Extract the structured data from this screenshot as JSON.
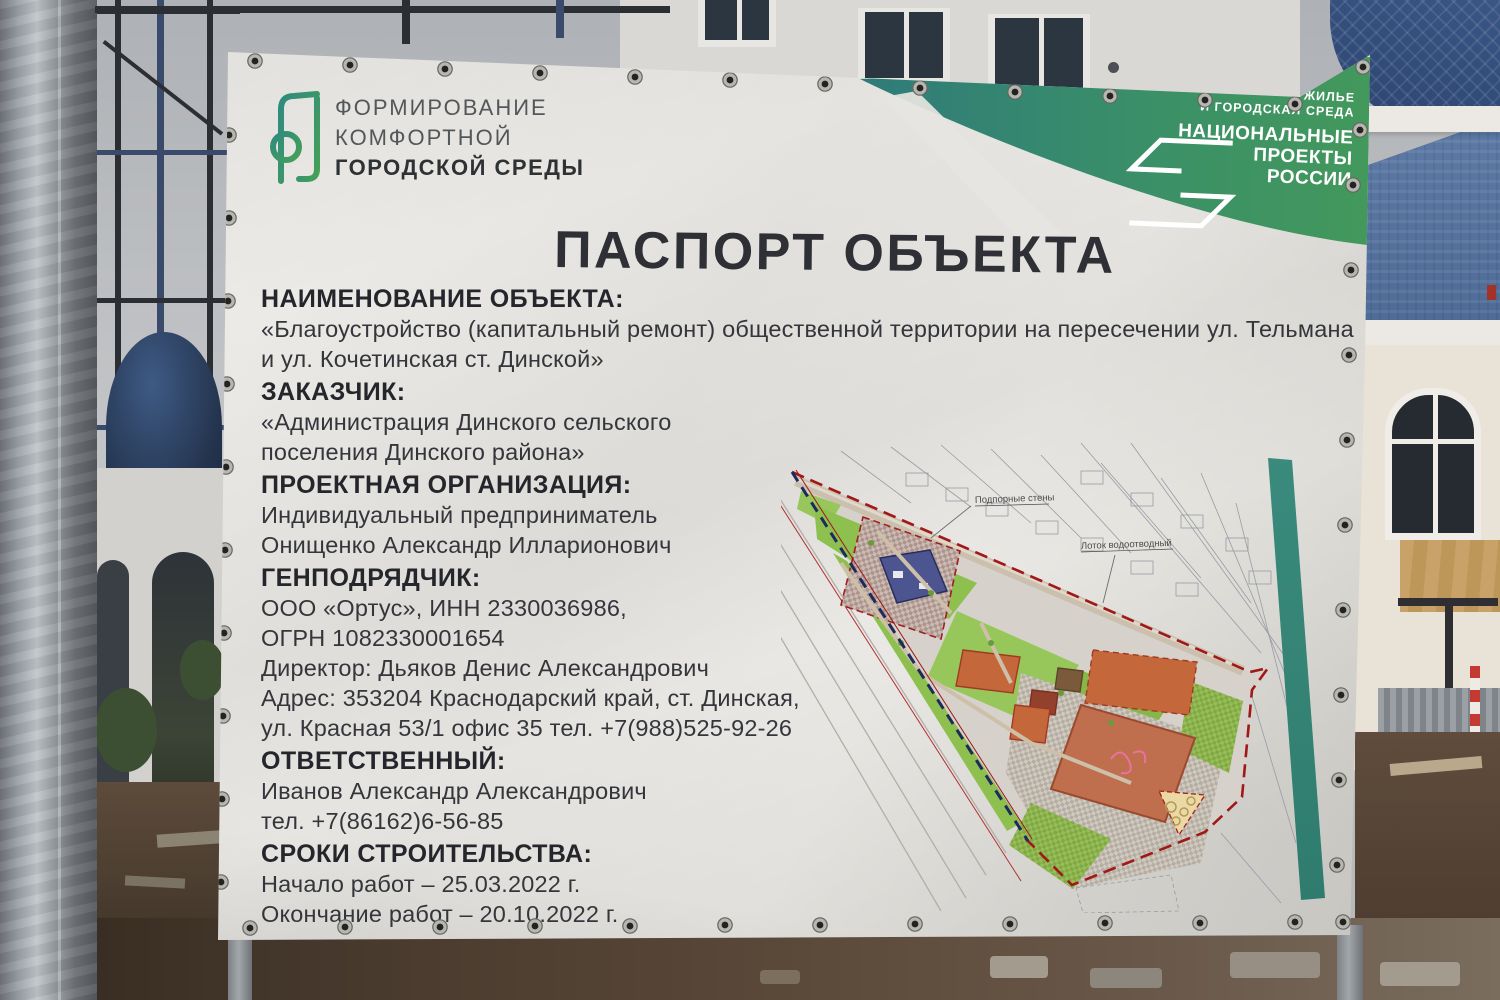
{
  "banner": {
    "program_logo": {
      "line1": "ФОРМИРОВАНИЕ",
      "line2": "КОМФОРТНОЙ",
      "line3": "ГОРОДСКОЙ СРЕДЫ"
    },
    "national_projects_badge": {
      "tagline1": "ЖИЛЬЕ",
      "tagline2": "И ГОРОДСКАЯ СРЕДА",
      "title1": "НАЦИОНАЛЬНЫЕ",
      "title2": "ПРОЕКТЫ",
      "title3": "РОССИИ"
    },
    "title": "ПАСПОРТ ОБЪЕКТА",
    "sections": [
      {
        "heading": "НАИМЕНОВАНИЕ ОБЪЕКТА:",
        "lines": [
          "«Благоустройство (капитальный ремонт) общественной территории на пересечении ул. Тельмана",
          "и ул. Кочетинская ст. Динской»"
        ]
      },
      {
        "heading": "ЗАКАЗЧИК:",
        "lines": [
          "«Администрация Динского сельского",
          "поселения Динского района»"
        ]
      },
      {
        "heading": "ПРОЕКТНАЯ ОРГАНИЗАЦИЯ:",
        "lines": [
          "Индивидуальный предприниматель",
          "Онищенко Александр Илларионович"
        ]
      },
      {
        "heading": "ГЕНПОДРЯДЧИК:",
        "lines": [
          "ООО «Ортус», ИНН 2330036986,",
          "ОГРН 1082330001654",
          "Директор: Дьяков Денис Александрович",
          "Адрес: 353204 Краснодарский край, ст. Динская,",
          "ул. Красная 53/1 офис 35 тел. +7(988)525-92-26"
        ]
      },
      {
        "heading": "ОТВЕТСТВЕННЫЙ:",
        "lines": [
          "Иванов Александр Александрович",
          "тел. +7(86162)6-56-85"
        ]
      },
      {
        "heading": "СРОКИ СТРОИТЕЛЬСТВА:",
        "lines": [
          "Начало работ – 25.03.2022 г.",
          "Окончание работ – 20.10.2022 г."
        ]
      }
    ],
    "site_plan_labels": {
      "retaining_walls": "Подпорные стены",
      "drainage_tray": "Лоток водоотводный"
    }
  },
  "colors": {
    "brand_teal": "#2f7b7a",
    "brand_green": "#43985c",
    "banner_bg": "#e6e4e0",
    "title_text": "#2e3036",
    "plan_lawn_green": "#8ec04f",
    "plan_building_blue": "#4d5590",
    "plan_building_orange": "#c4683c",
    "plan_field_terracotta": "#bf6e4e",
    "plan_boundary_red": "#a01818",
    "plan_boundary_blue": "#1d2a5e",
    "teal_stripe": "#3a8b7d"
  }
}
